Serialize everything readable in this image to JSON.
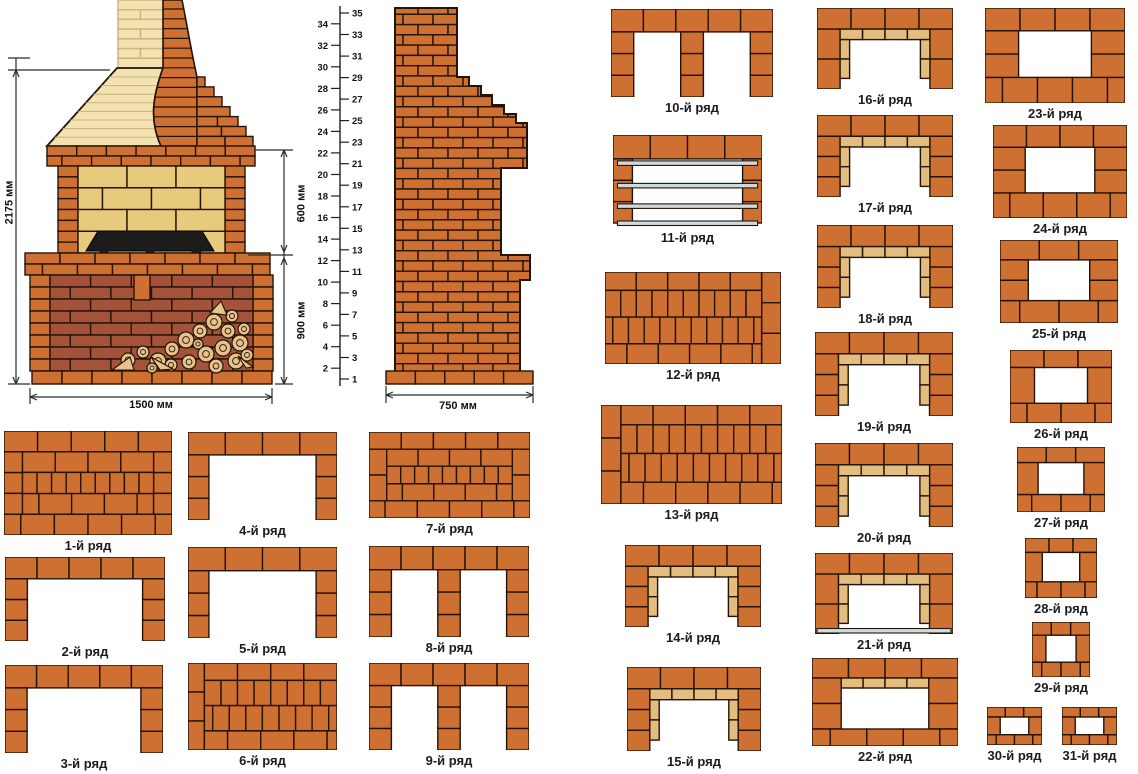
{
  "title": "Порядовка кирпичной печи-барбекю",
  "colors": {
    "brick": "#ce7031",
    "brick_dark": "#a5523a",
    "cream": "#f3e2b2",
    "cream_joint": "#cfb27c",
    "firebox_tan": "#e7ca7c",
    "lining_tan": "#e2bd7d",
    "steel": "#ccdae2",
    "grill": "#1c1c1c",
    "outline": "#241307",
    "dim_line": "#2b2b2b",
    "label": "#1c1c1c"
  },
  "dimensions": {
    "total_height": "2175 мм",
    "firebox_height": "600 мм",
    "base_height": "900 мм",
    "front_width": "1500 мм",
    "side_depth": "750 мм"
  },
  "ruler": {
    "min": 1,
    "max": 35
  },
  "row_diagrams": [
    {
      "label": "1-й ряд",
      "type": "solid-mixed",
      "x": 4,
      "y": 431,
      "w": 168,
      "h": 104
    },
    {
      "label": "2-й ряд",
      "type": "u",
      "x": 5,
      "y": 557,
      "w": 160,
      "h": 84
    },
    {
      "label": "3-й ряд",
      "type": "u",
      "x": 5,
      "y": 665,
      "w": 158,
      "h": 88
    },
    {
      "label": "4-й ряд",
      "type": "u",
      "x": 188,
      "y": 432,
      "w": 149,
      "h": 88
    },
    {
      "label": "5-й ряд",
      "type": "u",
      "x": 188,
      "y": 547,
      "w": 149,
      "h": 91
    },
    {
      "label": "6-й ряд",
      "type": "solid-v-left",
      "x": 188,
      "y": 663,
      "w": 149,
      "h": 87
    },
    {
      "label": "7-й ряд",
      "type": "solid-mixed",
      "x": 369,
      "y": 432,
      "w": 161,
      "h": 86
    },
    {
      "label": "8-й ряд",
      "type": "u-mid",
      "x": 369,
      "y": 546,
      "w": 160,
      "h": 91
    },
    {
      "label": "9-й ряд",
      "type": "u-mid",
      "x": 369,
      "y": 663,
      "w": 160,
      "h": 87
    },
    {
      "label": "10-й ряд",
      "type": "u-mid",
      "x": 611,
      "y": 9,
      "w": 162,
      "h": 88
    },
    {
      "label": "11-й ряд",
      "type": "grate",
      "x": 613,
      "y": 135,
      "w": 149,
      "h": 92
    },
    {
      "label": "12-й ряд",
      "type": "solid-v-right",
      "x": 605,
      "y": 272,
      "w": 176,
      "h": 92
    },
    {
      "label": "13-й ряд",
      "type": "solid-v-left",
      "x": 601,
      "y": 405,
      "w": 181,
      "h": 99
    },
    {
      "label": "14-й ряд",
      "type": "u-lined",
      "x": 625,
      "y": 545,
      "w": 136,
      "h": 82
    },
    {
      "label": "15-й ряд",
      "type": "u-lined",
      "x": 627,
      "y": 667,
      "w": 134,
      "h": 84
    },
    {
      "label": "16-й ряд",
      "type": "u-lined",
      "x": 817,
      "y": 8,
      "w": 136,
      "h": 81
    },
    {
      "label": "17-й ряд",
      "type": "u-lined",
      "x": 817,
      "y": 115,
      "w": 136,
      "h": 82
    },
    {
      "label": "18-й ряд",
      "type": "u-lined",
      "x": 817,
      "y": 225,
      "w": 136,
      "h": 83
    },
    {
      "label": "19-й ряд",
      "type": "u-lined",
      "x": 815,
      "y": 332,
      "w": 138,
      "h": 84
    },
    {
      "label": "20-й ряд",
      "type": "u-lined",
      "x": 815,
      "y": 443,
      "w": 138,
      "h": 84
    },
    {
      "label": "21-й ряд",
      "type": "u-lined-steel",
      "x": 815,
      "y": 553,
      "w": 138,
      "h": 81
    },
    {
      "label": "22-й ряд",
      "type": "frame-lined",
      "x": 812,
      "y": 658,
      "w": 146,
      "h": 88
    },
    {
      "label": "23-й ряд",
      "type": "frame",
      "x": 985,
      "y": 8,
      "w": 140,
      "h": 95
    },
    {
      "label": "24-й ряд",
      "type": "frame",
      "x": 993,
      "y": 125,
      "w": 134,
      "h": 93
    },
    {
      "label": "25-й ряд",
      "type": "frame",
      "x": 1000,
      "y": 240,
      "w": 118,
      "h": 83
    },
    {
      "label": "26-й ряд",
      "type": "frame",
      "x": 1010,
      "y": 350,
      "w": 102,
      "h": 73
    },
    {
      "label": "27-й ряд",
      "type": "frame",
      "x": 1017,
      "y": 447,
      "w": 88,
      "h": 65
    },
    {
      "label": "28-й ряд",
      "type": "frame",
      "x": 1025,
      "y": 538,
      "w": 72,
      "h": 60
    },
    {
      "label": "29-й ряд",
      "type": "frame",
      "x": 1032,
      "y": 622,
      "w": 58,
      "h": 55
    },
    {
      "label": "30-й ряд",
      "type": "frame",
      "x": 987,
      "y": 707,
      "w": 55,
      "h": 38
    },
    {
      "label": "31-й ряд",
      "type": "frame",
      "x": 1062,
      "y": 707,
      "w": 55,
      "h": 38
    }
  ]
}
